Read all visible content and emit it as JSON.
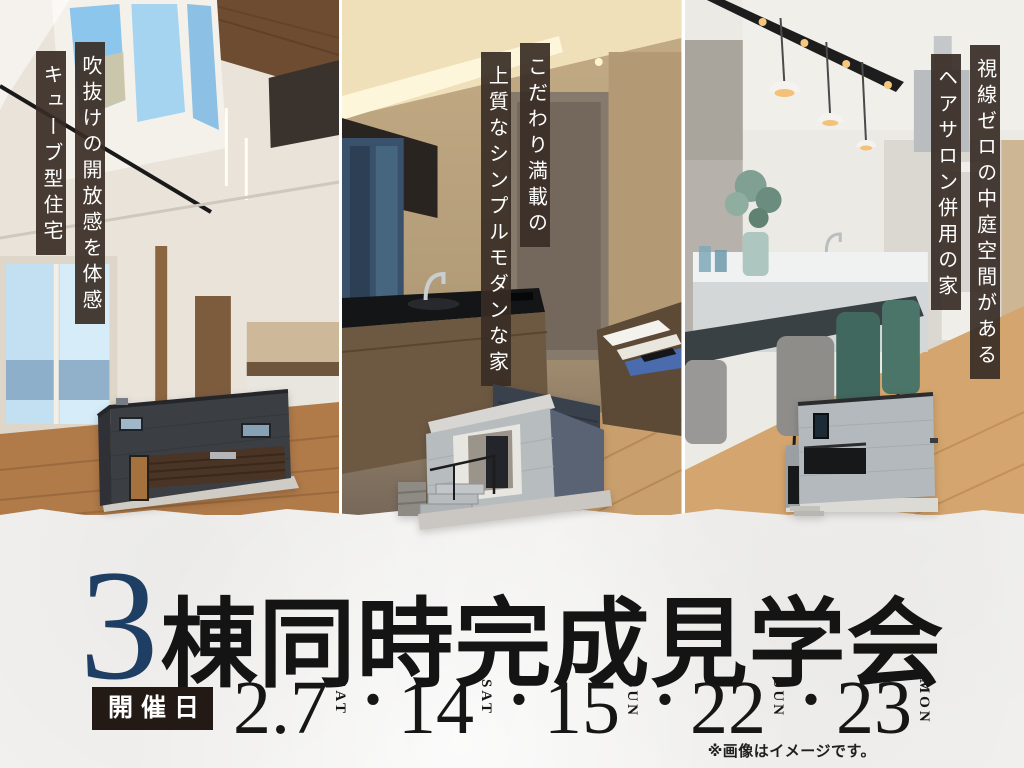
{
  "panels": [
    {
      "caption_primary": "吹抜けの開放感を体感",
      "caption_secondary": "キューブ型住宅"
    },
    {
      "caption_primary": "こだわり満載の",
      "caption_secondary": "上質なシンプルモダンな家"
    },
    {
      "caption_primary": "視線ゼロの中庭空間がある",
      "caption_secondary": "ヘアサロン併用の家"
    }
  ],
  "event": {
    "title_number": "3",
    "title_text": "棟同時完成見学会",
    "date_label": "開催日",
    "separator": "・",
    "dates": [
      {
        "day": "2.7",
        "weekday": "SAT"
      },
      {
        "day": "14",
        "weekday": "SAT"
      },
      {
        "day": "15",
        "weekday": "SUN"
      },
      {
        "day": "22",
        "weekday": "SUN"
      },
      {
        "day": "23",
        "weekday": "MON"
      }
    ]
  },
  "flyer": {
    "disclaimer": "※画像はイメージです。"
  },
  "colors": {
    "accent_navy": "#1e3f63",
    "caption_bar_brown": "#382c25",
    "date_label_box_brown": "#231a15",
    "paper_background": "#f3f2f0",
    "title_black": "#141414"
  }
}
